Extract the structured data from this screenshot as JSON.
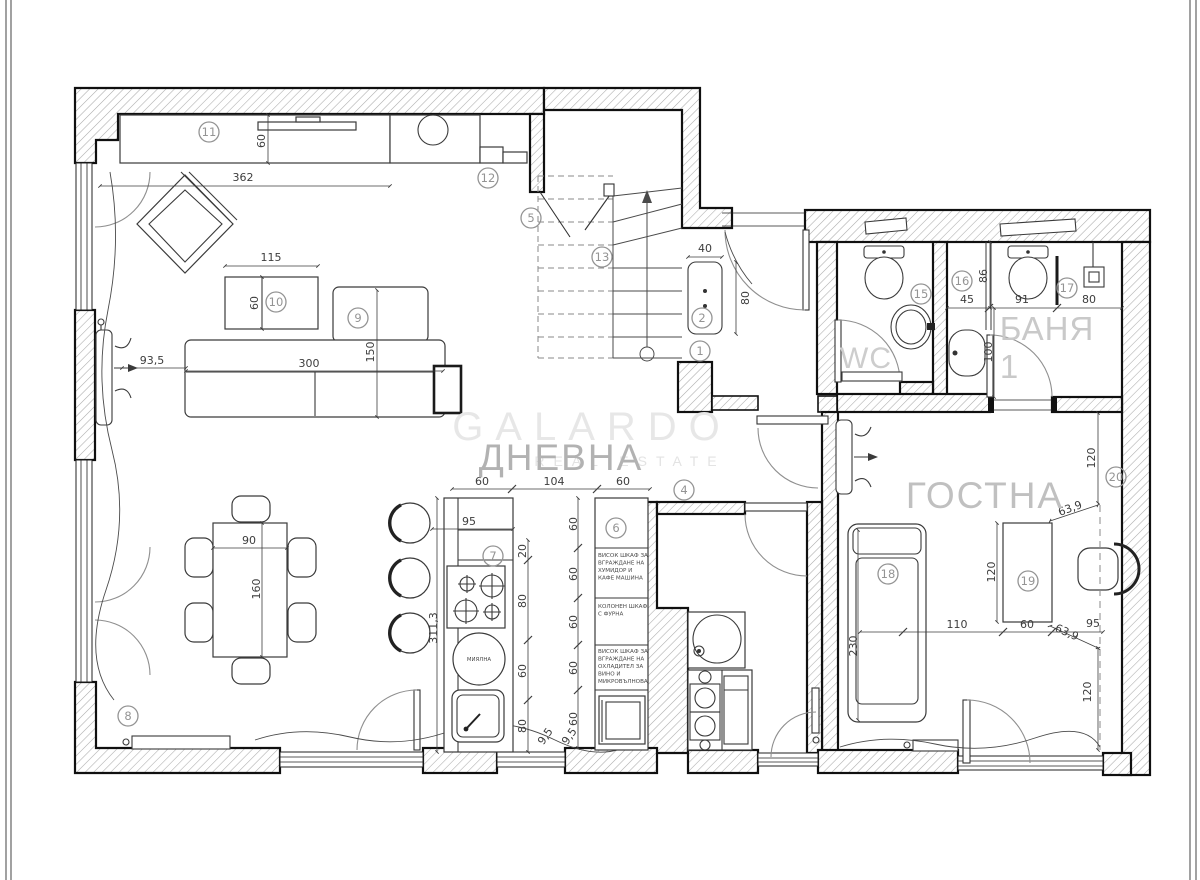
{
  "watermark": {
    "brand": "GALARDO",
    "tagline": "REAL ESTATE"
  },
  "rooms": {
    "living": "ДНЕВНА",
    "guest": "ГОСТНА",
    "wc": "WC",
    "bath": "БАНЯ",
    "bath_number": "1"
  },
  "appliances": {
    "dishwasher": "МИЯЛНА"
  },
  "cabinet_notes": {
    "humidor": [
      "ВИСОК ШКАФ ЗА",
      "ВГРАЖДАНЕ НА",
      "ХУМИДОР И",
      "КАФЕ МАШИНА"
    ],
    "oven": [
      "КОЛОНЕН ШКАФ",
      "С ФУРНА"
    ],
    "wine": [
      "ВИСОК ШКАФ ЗА",
      "ВГРАЖДАНЕ НА",
      "ОХЛАДИТЕЛ ЗА",
      "ВИНО И",
      "МИКРОВЪЛНОВА"
    ]
  },
  "markers": {
    "m1": "1",
    "m2": "2",
    "m4": "4",
    "m5": "5",
    "m6": "6",
    "m7": "7",
    "m8": "8",
    "m9": "9",
    "m10": "10",
    "m11": "11",
    "m12": "12",
    "m13": "13",
    "m15": "15",
    "m16": "16",
    "m17": "17",
    "m18": "18",
    "m19": "19",
    "m20": "20"
  },
  "dims": {
    "tv_len": "362",
    "tv_depth": "60",
    "coffee_w": "115",
    "coffee_d": "60",
    "sofa_offset": "93,5",
    "sofa_len": "300",
    "chaise": "150",
    "rad_w": "40",
    "rad_h": "80",
    "bath45": "45",
    "bath86": "86",
    "bath91": "91",
    "bath80": "80",
    "bath100": "100",
    "guest_win_top": "120",
    "diag_top": "63,9",
    "desk_len": "120",
    "guest110": "110",
    "desk_w": "60",
    "diag_bot": "63,9",
    "guest95": "95",
    "guest_win_bot": "120",
    "sofa_bed": "230",
    "table_w": "90",
    "table_l": "160",
    "kit60a": "60",
    "kit104": "104",
    "kit60b": "60",
    "kit95": "95",
    "kit311": "311,3",
    "kit20": "20",
    "kit80a": "80",
    "kit60mid": "60",
    "kit80b": "80",
    "kit95a": "9,5",
    "kit95b": "9,5",
    "cab60_1": "60",
    "cab60_2": "60",
    "cab60_3": "60",
    "cab60_4": "60",
    "cab60_5": "60"
  },
  "colors": {
    "wall_line": "#101010",
    "dim_text": "#3d3d3d",
    "marker": "#949494",
    "watermark": "#e6e6e6",
    "room_label": "#bdbdbd"
  }
}
